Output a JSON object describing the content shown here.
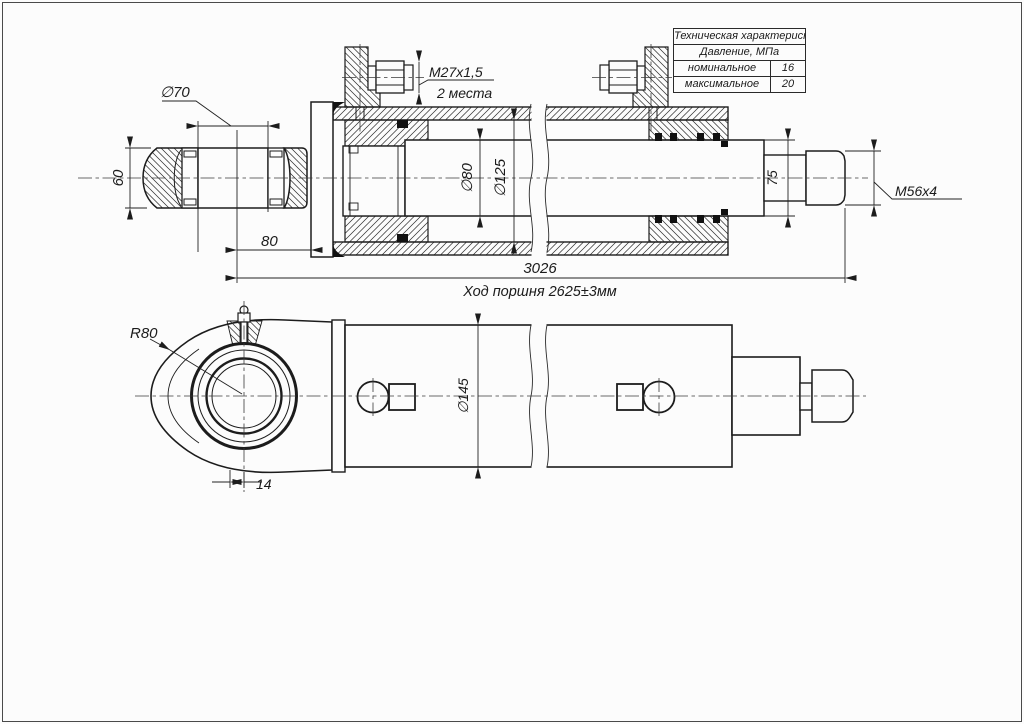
{
  "table": {
    "header": "Техническая характеристика",
    "subheader": "Давление, МПа",
    "rows": [
      {
        "label": "номинальное",
        "value": "16"
      },
      {
        "label": "максимальное",
        "value": "20"
      }
    ]
  },
  "dims": {
    "top": {
      "eye_bore": "∅70",
      "eye_width": "60",
      "eye_to_flange": "80",
      "port_thread": "M27x1,5",
      "port_places": "2 места",
      "rod_diameter": "∅80",
      "bore_diameter": "∅125",
      "rod_end_diameter": "75",
      "rod_thread": "M56x4",
      "overall_length": "3026",
      "piston_stroke": "Ход поршня 2625±3мм"
    },
    "bottom": {
      "eye_radius": "R80",
      "eye_offset": "14",
      "outer_diameter": "∅145"
    }
  },
  "colors": {
    "line": "#1c1c1c",
    "thin_line": "#2a2a2a",
    "background": "#fcfcfc"
  }
}
